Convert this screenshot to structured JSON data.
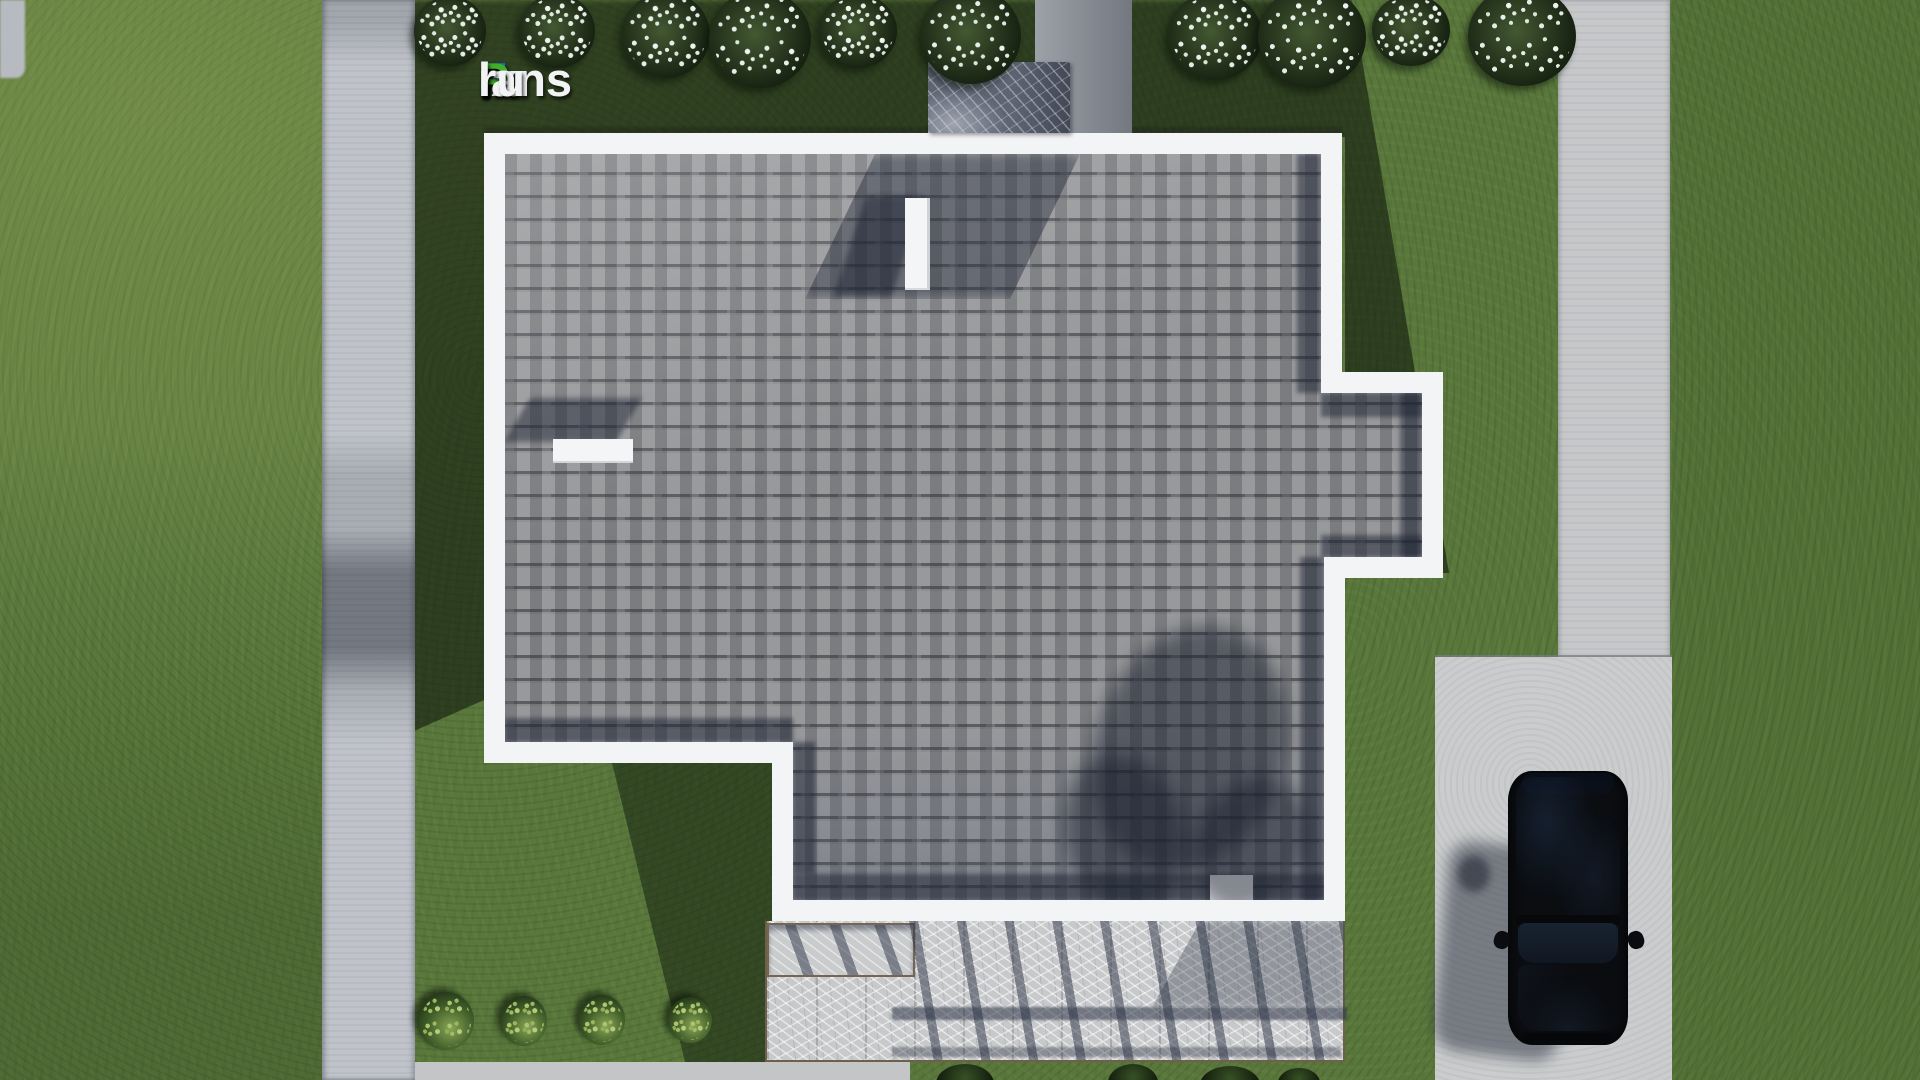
{
  "brand": {
    "logo": {
      "full_text": "FixPlans.ru",
      "part_f": "F",
      "part_ix": "ix",
      "part_p": "P",
      "part_lans": "lans",
      "part_dot": ".",
      "part_ru": "ru",
      "color_blue": "#1e6fd2",
      "color_green": "#3fae2a",
      "color_white": "#f2f3f4"
    }
  },
  "scene": {
    "type": "aerial-top-down-render-of-house-plan",
    "objects": [
      "lawn",
      "left-walkway",
      "right-walkway",
      "driveway",
      "black-car",
      "house-roof-shingles",
      "white-roof-parapet",
      "chimney-stack",
      "roof-chimney",
      "roof-vents",
      "terrace-with-pergola-shadow",
      "flowering-bushes-row-top",
      "green-bushes-row-bottom"
    ],
    "colors": {
      "grass_sunlit": "#5a783c",
      "grass_shadow": "#283c20",
      "concrete_path": "#c0c4ca",
      "driveway": "#cacccd",
      "roof_shingles": "#98999b",
      "roof_parapet": "#f3f4f5",
      "terrace_marble": "#c7c9cb",
      "terrace_border": "#6f604c",
      "chimney_marble": "#5d6472",
      "car_body": "#0b0d11",
      "shadow_navy": "#1c2232"
    }
  }
}
